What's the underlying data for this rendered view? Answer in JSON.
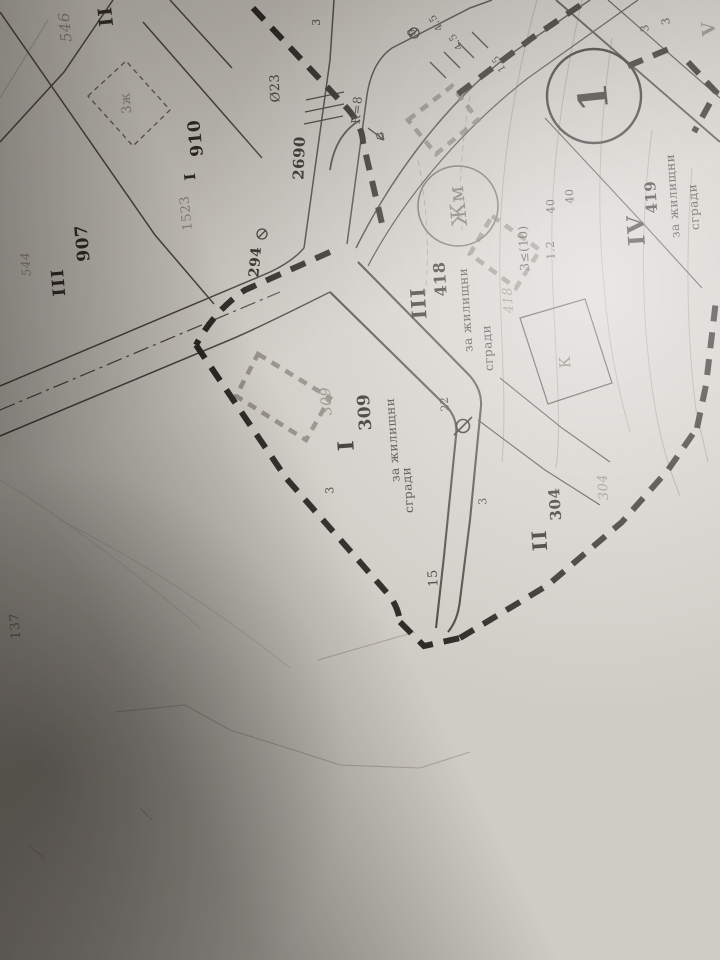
{
  "meta": {
    "description": "Photograph of a paper cadastral regulation plan (urban development map), Bulgarian",
    "block_number_in_circle": "1",
    "zone_symbol": "Жм"
  },
  "palette": {
    "paper": "#cfccc5",
    "ink_dark": "#27221c",
    "ink_thin": "#46403a",
    "ink_faint": "#8d867c",
    "boundary": "#241f1a",
    "building_gray": "#857e74",
    "green_note": "#767a60"
  },
  "parcels": [
    {
      "roman": "I",
      "number": "309",
      "old_number": "309",
      "use": "за жилищни сгради"
    },
    {
      "roman": "II",
      "number": "304",
      "old_number": "304",
      "use": ""
    },
    {
      "roman": "III",
      "number": "418",
      "old_number": "418",
      "use": "за жилищни сгради"
    },
    {
      "roman": "IV",
      "number": "419",
      "old_number": "",
      "use": "за жилищни сгради"
    },
    {
      "roman": "I",
      "number": "910",
      "old_number": "1523",
      "use": ""
    },
    {
      "roman": "II",
      "number": "",
      "old_number": "546",
      "use": ""
    },
    {
      "roman": "III",
      "number": "907",
      "old_number": "544",
      "use": ""
    }
  ],
  "annotations": [
    {
      "id": "p546",
      "text": "546",
      "x": 66,
      "y": 27,
      "rot": -96,
      "cls": "it faint",
      "fs": 15
    },
    {
      "id": "pII-top",
      "text": "II",
      "x": 107,
      "y": 16,
      "rot": -96,
      "cls": "roman",
      "fs": 19
    },
    {
      "id": "b3zh",
      "text": "3ж",
      "x": 127,
      "y": 103,
      "rot": -96,
      "cls": "faint",
      "fs": 13
    },
    {
      "id": "p910",
      "text": "910",
      "x": 197,
      "y": 138,
      "rot": -96,
      "cls": "bold",
      "fs": 17
    },
    {
      "id": "pI-910",
      "text": "I",
      "x": 191,
      "y": 176,
      "rot": -96,
      "cls": "roman",
      "fs": 15
    },
    {
      "id": "p1523",
      "text": "1523",
      "x": 187,
      "y": 213,
      "rot": -96,
      "cls": "faint",
      "fs": 13
    },
    {
      "id": "p907",
      "text": "907",
      "x": 84,
      "y": 243,
      "rot": -95,
      "cls": "bold",
      "fs": 17
    },
    {
      "id": "pIII-907",
      "text": "III",
      "x": 60,
      "y": 282,
      "rot": -95,
      "cls": "roman",
      "fs": 17
    },
    {
      "id": "p544",
      "text": "544",
      "x": 26,
      "y": 264,
      "rot": -95,
      "cls": "it faint",
      "fs": 12
    },
    {
      "id": "d23",
      "text": "Ø23",
      "x": 276,
      "y": 88,
      "rot": -92,
      "cls": "",
      "fs": 13
    },
    {
      "id": "p2690",
      "text": "2690",
      "x": 300,
      "y": 158,
      "rot": -88,
      "cls": "bold",
      "fs": 15
    },
    {
      "id": "p294",
      "text": "294",
      "x": 256,
      "y": 262,
      "rot": -85,
      "cls": "bold",
      "fs": 14
    },
    {
      "id": "r8",
      "text": "R=8",
      "x": 357,
      "y": 110,
      "rot": -85,
      "cls": "",
      "fs": 12
    },
    {
      "id": "n3a",
      "text": "3",
      "x": 381,
      "y": 135,
      "rot": -90,
      "cls": "",
      "fs": 11
    },
    {
      "id": "n3b",
      "text": "3",
      "x": 317,
      "y": 22,
      "rot": -90,
      "cls": "",
      "fs": 11
    },
    {
      "id": "n9",
      "text": "9",
      "x": 412,
      "y": 32,
      "rot": -95,
      "cls": "",
      "fs": 11
    },
    {
      "id": "n45a",
      "text": "4.5",
      "x": 437,
      "y": 22,
      "rot": -122,
      "cls": "",
      "fs": 10
    },
    {
      "id": "n45b",
      "text": "4.5",
      "x": 457,
      "y": 41,
      "rot": -122,
      "cls": "",
      "fs": 10
    },
    {
      "id": "n15a",
      "text": "1.5",
      "x": 500,
      "y": 63,
      "rot": -122,
      "cls": "",
      "fs": 10
    },
    {
      "id": "n3c",
      "text": "3",
      "x": 645,
      "y": 28,
      "rot": -100,
      "cls": "",
      "fs": 11
    },
    {
      "id": "n3d",
      "text": "3",
      "x": 666,
      "y": 21,
      "rot": -100,
      "cls": "",
      "fs": 11
    },
    {
      "id": "vpart",
      "text": "V",
      "x": 710,
      "y": 28,
      "rot": -96,
      "cls": "faint roman",
      "fs": 18
    },
    {
      "id": "block1",
      "text": "1",
      "x": 594,
      "y": 97,
      "rot": -96,
      "cls": "bold",
      "fs": 40
    },
    {
      "id": "zhm",
      "text": "Жм",
      "x": 458,
      "y": 206,
      "rot": -96,
      "cls": "gray",
      "fs": 21
    },
    {
      "id": "n3-10",
      "text": "3≤(10)",
      "x": 524,
      "y": 248,
      "rot": -93,
      "cls": "",
      "fs": 12
    },
    {
      "id": "n12",
      "text": "1.2",
      "x": 551,
      "y": 250,
      "rot": -93,
      "cls": "",
      "fs": 11
    },
    {
      "id": "n40a",
      "text": "40",
      "x": 551,
      "y": 206,
      "rot": -93,
      "cls": "",
      "fs": 11
    },
    {
      "id": "n40b",
      "text": "40",
      "x": 570,
      "y": 196,
      "rot": -93,
      "cls": "",
      "fs": 11
    },
    {
      "id": "pIII-418",
      "text": "III",
      "x": 419,
      "y": 303,
      "rot": -94,
      "cls": "roman",
      "fs": 20
    },
    {
      "id": "p418",
      "text": "418",
      "x": 441,
      "y": 279,
      "rot": -94,
      "cls": "bold",
      "fs": 16
    },
    {
      "id": "p418i",
      "text": "418",
      "x": 509,
      "y": 300,
      "rot": -94,
      "cls": "it faint",
      "fs": 13
    },
    {
      "id": "t418a",
      "text": "за жилищни",
      "x": 466,
      "y": 310,
      "rot": -94,
      "cls": "",
      "fs": 12
    },
    {
      "id": "t418b",
      "text": "сгради",
      "x": 488,
      "y": 348,
      "rot": -94,
      "cls": "",
      "fs": 12
    },
    {
      "id": "pI-309",
      "text": "I",
      "x": 347,
      "y": 445,
      "rot": -94,
      "cls": "roman",
      "fs": 22
    },
    {
      "id": "p309",
      "text": "309",
      "x": 366,
      "y": 412,
      "rot": -94,
      "cls": "bold",
      "fs": 17
    },
    {
      "id": "p309i",
      "text": "309",
      "x": 327,
      "y": 401,
      "rot": -94,
      "cls": "it faint",
      "fs": 14
    },
    {
      "id": "t309a",
      "text": "за жилищни",
      "x": 393,
      "y": 440,
      "rot": -94,
      "cls": "",
      "fs": 12
    },
    {
      "id": "t309b",
      "text": "сгради",
      "x": 408,
      "y": 490,
      "rot": -94,
      "cls": "",
      "fs": 12
    },
    {
      "id": "n22",
      "text": "22",
      "x": 445,
      "y": 404,
      "rot": -94,
      "cls": "",
      "fs": 11
    },
    {
      "id": "kap",
      "text": "К",
      "x": 566,
      "y": 362,
      "rot": -94,
      "cls": "gray",
      "fs": 15
    },
    {
      "id": "n3e",
      "text": "3",
      "x": 330,
      "y": 490,
      "rot": -94,
      "cls": "",
      "fs": 11
    },
    {
      "id": "n3f",
      "text": "3",
      "x": 483,
      "y": 501,
      "rot": -94,
      "cls": "",
      "fs": 11
    },
    {
      "id": "n15",
      "text": "15",
      "x": 434,
      "y": 578,
      "rot": -94,
      "cls": "",
      "fs": 13
    },
    {
      "id": "pII-304",
      "text": "II",
      "x": 540,
      "y": 540,
      "rot": -94,
      "cls": "roman",
      "fs": 20
    },
    {
      "id": "p304",
      "text": "304",
      "x": 556,
      "y": 504,
      "rot": -94,
      "cls": "bold",
      "fs": 15
    },
    {
      "id": "p304i",
      "text": "304",
      "x": 604,
      "y": 487,
      "rot": -94,
      "cls": "it faint",
      "fs": 13
    },
    {
      "id": "pIV-419",
      "text": "IV",
      "x": 637,
      "y": 230,
      "rot": -94,
      "cls": "roman",
      "fs": 23
    },
    {
      "id": "p419",
      "text": "419",
      "x": 652,
      "y": 197,
      "rot": -94,
      "cls": "bold",
      "fs": 15
    },
    {
      "id": "t419a",
      "text": "за жилищни",
      "x": 673,
      "y": 196,
      "rot": -94,
      "cls": "",
      "fs": 12
    },
    {
      "id": "t419b",
      "text": "сгради",
      "x": 694,
      "y": 207,
      "rot": -94,
      "cls": "",
      "fs": 12
    },
    {
      "id": "p137",
      "text": "137",
      "x": 16,
      "y": 626,
      "rot": -94,
      "cls": "green faint",
      "fs": 13
    }
  ]
}
